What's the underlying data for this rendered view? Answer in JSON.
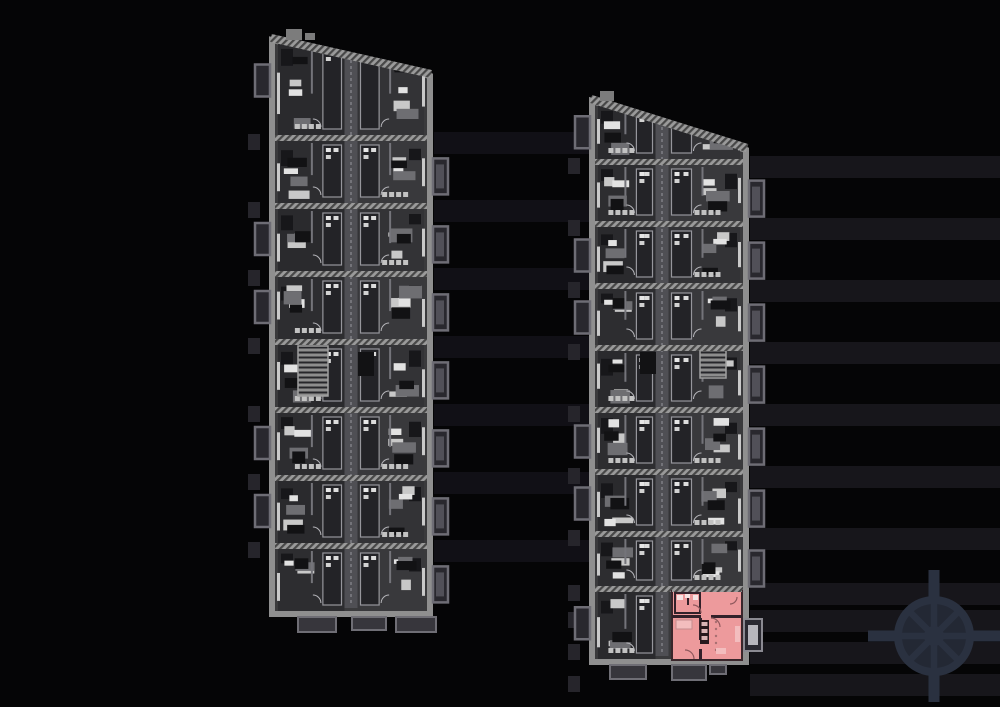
{
  "canvas": {
    "width": 1000,
    "height": 707,
    "background": "#050506"
  },
  "palette": {
    "wall": "#8f8f8f",
    "wallLight": "#a2a2a2",
    "interior": "#3a3a3c",
    "corridor": "#4f4f54",
    "corridorLine": "#97979e",
    "windowLight": "#c9c9c9",
    "roomFills": [
      "#333336",
      "#2d2d30",
      "#39393c",
      "#2a2a2d"
    ],
    "balconyFill": "#29282e",
    "balconyStroke": "#6e6d75",
    "bandGap": "#111016",
    "bandRight": "#17161b",
    "edgeMark": "#26252b",
    "porchFill": "#37363c",
    "porchStroke": "#6f6e75",
    "stairStroke": "#a0a0a0",
    "roofNub": "#7c7c7c"
  },
  "buildings": [
    {
      "name": "building-left",
      "x0": 272,
      "x1": 430,
      "yTL": 40,
      "yTR": 76,
      "yB": 614,
      "corridor": {
        "x": 351,
        "w": 13
      },
      "dividers": [
        138,
        206,
        274,
        342,
        410,
        478,
        546
      ],
      "stair": {
        "x": 298,
        "y": 346,
        "w": 30,
        "h": 50
      },
      "elevator": [
        358,
        352,
        16,
        24
      ],
      "balconiesRight": [
        1,
        2,
        3,
        4,
        5,
        6,
        7
      ],
      "balconiesLeft": [
        0,
        2,
        3,
        5,
        6
      ],
      "bottoms": [
        [
          298,
          38,
          15
        ],
        [
          352,
          34,
          13
        ],
        [
          396,
          40,
          15
        ]
      ],
      "nubs": [
        [
          286,
          29,
          16,
          11
        ],
        [
          305,
          33,
          10,
          7
        ]
      ],
      "bandWidth": 170,
      "bandColor": "#111016",
      "extraBands": [],
      "seed": 3,
      "highlight": false
    },
    {
      "name": "building-right",
      "x0": 592,
      "x1": 746,
      "yTL": 101,
      "yTR": 150,
      "yB": 662,
      "corridor": {
        "x": 662,
        "w": 13
      },
      "dividers": [
        162,
        224,
        286,
        348,
        410,
        472,
        534,
        589
      ],
      "stair": {
        "x": 700,
        "y": 350,
        "w": 26,
        "h": 28
      },
      "elevator": [
        640,
        352,
        16,
        22
      ],
      "balconiesRight": [
        1,
        2,
        3,
        4,
        5,
        6,
        7
      ],
      "balconiesLeft": [
        0,
        2,
        3,
        5,
        6,
        8
      ],
      "bottoms": [
        [
          610,
          36,
          14
        ],
        [
          672,
          34,
          15
        ],
        [
          710,
          16,
          9
        ]
      ],
      "nubs": [
        [
          600,
          91,
          14,
          10
        ]
      ],
      "bandWidth": 254,
      "bandColor": "#17161b",
      "extraBands": [
        616,
        648,
        680
      ],
      "seed": 11,
      "highlight": true
    }
  ],
  "highlighted_apartment": {
    "x": 672,
    "y": 591,
    "w": 70,
    "h": 69,
    "fill": "#ed9a9c",
    "wall": "#33212a",
    "soft": "#f3bdbe",
    "fixture": "#f6e3e3",
    "accent": "#a86f72",
    "arcStroke": "#8f585c",
    "topBand": "#7a5356",
    "balcony": {
      "x": 744,
      "y": 619,
      "w": 18,
      "h": 32,
      "inner": "#b7b6bd"
    }
  },
  "compass": {
    "cx": 934,
    "cy": 636,
    "radius": 40,
    "color": "#2a3140",
    "disc": "#232834",
    "spokes": 8,
    "hubRadius": 10,
    "arm": {
      "len": 28,
      "w": 11
    }
  }
}
